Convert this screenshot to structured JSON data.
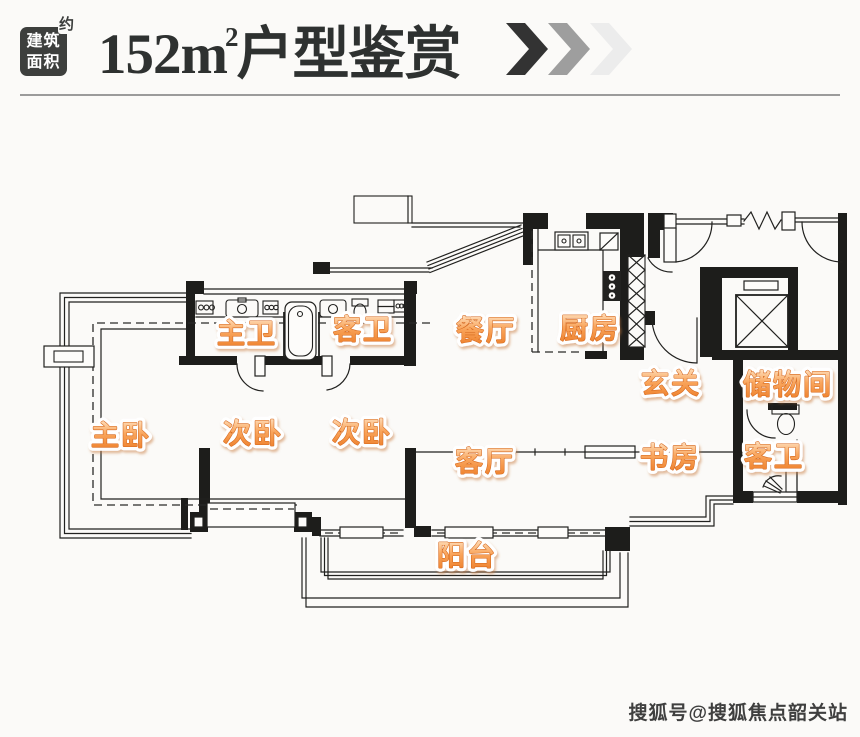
{
  "header": {
    "badge": {
      "line1": "建筑",
      "line2": "面积",
      "corner": "约",
      "bg_color": "#3d3f3d"
    },
    "title": {
      "prefix": "152m",
      "sup": "2",
      "suffix": "户型鉴赏",
      "color": "#2e3130"
    },
    "chevron_colors": [
      "#333333",
      "#9e9e9e",
      "#ececec"
    ]
  },
  "plan": {
    "rooms": [
      "主卫",
      "客卫",
      "餐厅",
      "厨房",
      "玄关",
      "储物间",
      "主卧",
      "次卧",
      "次卧",
      "客厅",
      "书房",
      "客卫",
      "阳台"
    ],
    "label_color": "#ec7c26",
    "line_color": "#21211f"
  },
  "watermark": {
    "text": "搜狐号@搜狐焦点韶关站"
  }
}
